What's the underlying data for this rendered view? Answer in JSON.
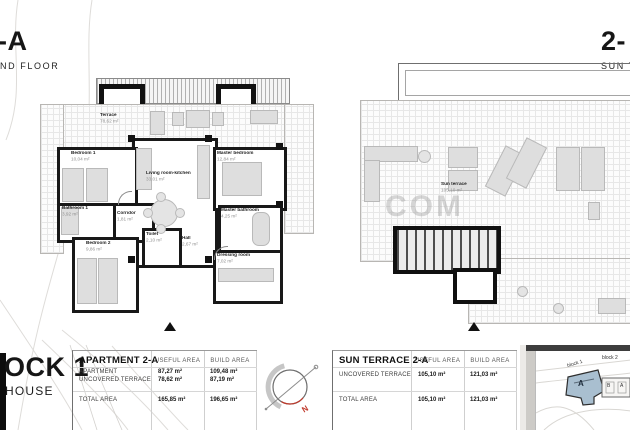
{
  "header_left": {
    "title": "-A",
    "subtitle": "ND FLOOR"
  },
  "header_right": {
    "title": "2-",
    "subtitle": "SUN TE"
  },
  "footer_brand": {
    "line1": "OCK 1",
    "line2": "HOUSE"
  },
  "watermark": "COM",
  "apartment_plan": {
    "rooms": [
      {
        "name": "Terrace",
        "area": "78,62 m²"
      },
      {
        "name": "Bedroom 1",
        "area": "10,04 m²"
      },
      {
        "name": "Bathroom 1",
        "area": "3,92 m²"
      },
      {
        "name": "Corridor",
        "area": "1,81 m²"
      },
      {
        "name": "Bedroom 2",
        "area": "9,86 m²"
      },
      {
        "name": "Toilet",
        "area": "2,10 m²"
      },
      {
        "name": "Hall",
        "area": "2,67 m²"
      },
      {
        "name": "Living room-kitchen",
        "area": "33,01 m²"
      },
      {
        "name": "Master bedroom",
        "area": "12,84 m²"
      },
      {
        "name": "Master bathroom",
        "area": "4,25 m²"
      },
      {
        "name": "Dressing room",
        "area": "7,02 m²"
      }
    ]
  },
  "terrace_plan": {
    "name": "Sun terrace",
    "area": "105,10 m²"
  },
  "compass": {
    "north_label": "N"
  },
  "tables": [
    {
      "title": "APARTMENT 2-A",
      "col_headers": [
        "USEFUL AREA",
        "BUILD AREA"
      ],
      "rows": [
        {
          "label": "APARTMENT",
          "useful": "87,27 m²",
          "build": "109,48 m²"
        },
        {
          "label": "UNCOVERED TERRACE",
          "useful": "78,62 m²",
          "build": "87,19 m²"
        }
      ],
      "total": {
        "label": "TOTAL AREA",
        "useful": "165,85 m²",
        "build": "196,65 m²"
      }
    },
    {
      "title": "SUN TERRACE 2-A",
      "col_headers": [
        "USEFUL AREA",
        "BUILD AREA"
      ],
      "rows": [
        {
          "label": "UNCOVERED TERRACE",
          "useful": "105,10 m²",
          "build": "121,03 m²"
        }
      ],
      "total": {
        "label": "TOTAL AREA",
        "useful": "105,10 m²",
        "build": "121,03 m²"
      }
    }
  ],
  "site_map": {
    "block1_label": "block 1",
    "block2_label": "block 2",
    "unit_label": "A",
    "block2_units": [
      "B",
      "A"
    ]
  }
}
